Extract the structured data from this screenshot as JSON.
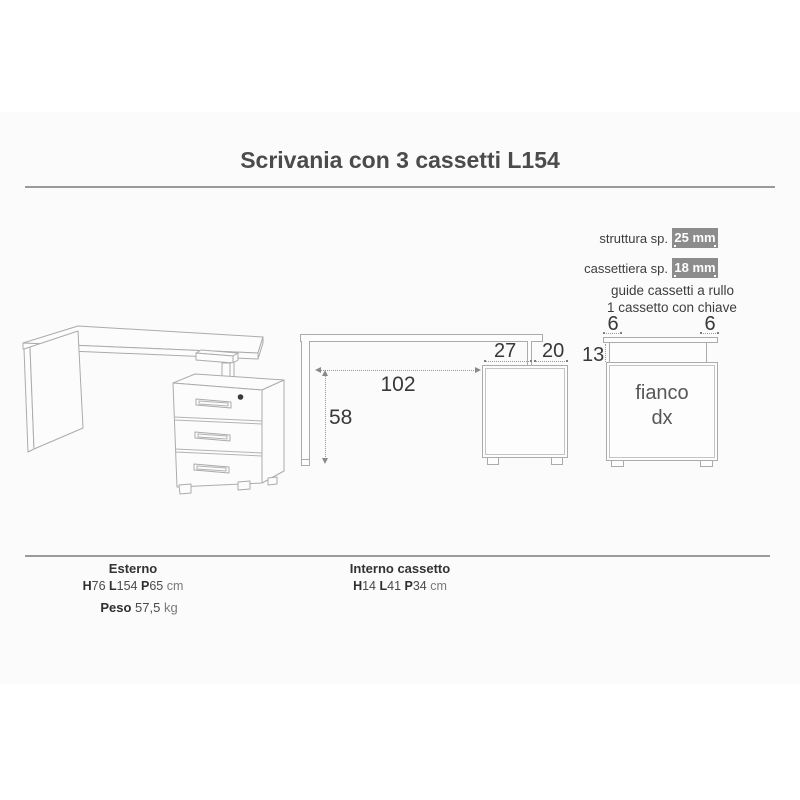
{
  "page": {
    "title": "Scrivania con 3 cassetti L154"
  },
  "thickness": {
    "rows": [
      {
        "label": "struttura sp.",
        "badge": "25 mm"
      },
      {
        "label": "cassettiera sp.",
        "badge": "18 mm"
      }
    ],
    "features": [
      "guide cassetti a rullo",
      "1 cassetto con chiave"
    ]
  },
  "front_view": {
    "dim_27": "27",
    "dim_20": "20",
    "dim_102": "102",
    "dim_58": "58"
  },
  "side_view": {
    "dim_left": "6",
    "dim_right": "6",
    "dim_13": "13",
    "label_line1": "fianco",
    "label_line2": "dx"
  },
  "bottom": {
    "esterno": {
      "title": "Esterno",
      "h": "H",
      "h_v": "76 ",
      "l": "L",
      "l_v": "154 ",
      "p": "P",
      "p_v": "65 ",
      "unit": "cm"
    },
    "peso": {
      "label": "Peso",
      "value": " 57,5 ",
      "unit": "kg"
    },
    "interno": {
      "title": "Interno cassetto",
      "h": "H",
      "h_v": "14 ",
      "l": "L",
      "l_v": "41 ",
      "p": "P",
      "p_v": "34 ",
      "unit": "cm"
    }
  },
  "colors": {
    "badge_bg": "#8c8c8c",
    "rule": "#9a9a9a",
    "drawing_stroke": "#ababab",
    "text_dark": "#3c3c3c"
  }
}
